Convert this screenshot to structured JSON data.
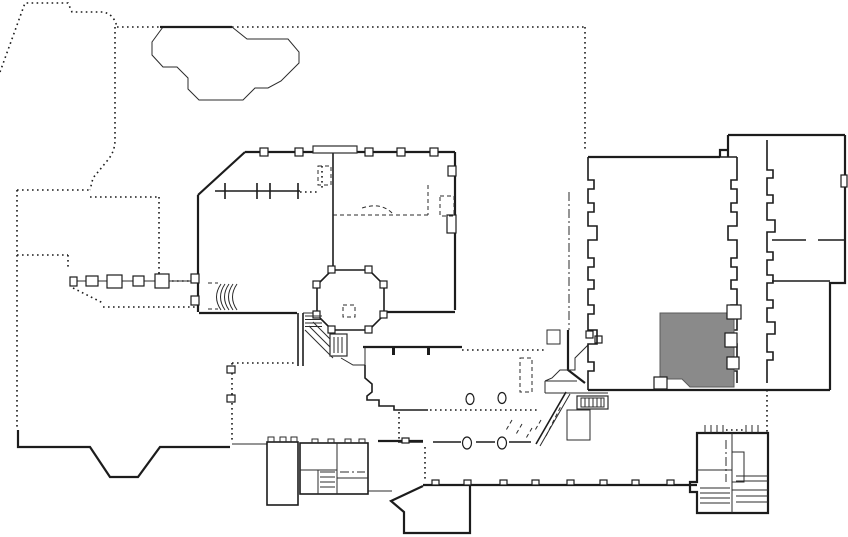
{
  "canvas": {
    "width": 848,
    "height": 537
  },
  "document": {
    "kind": "architectural-floor-plan",
    "visible_text": ""
  },
  "colors": {
    "background": "#ffffff",
    "wall": "#1c1c1c",
    "detail": "#2b2b2b",
    "highlight_fill": "#8a8a8a",
    "highlight_stroke": "#5a5a5a"
  },
  "highlighted_room": {
    "id": "highlighted-room",
    "state": "selected",
    "fill": "#8a8a8a"
  },
  "features": [
    "site-boundary-dotted-line",
    "pond-outline",
    "pergola-columns",
    "central-building",
    "octagonal-room",
    "curved-stair",
    "diagonal-stair",
    "south-terrace",
    "colonnade-with-oval-columns",
    "lower-room-block",
    "banquet-hall",
    "east-room-wing",
    "highlighted-room",
    "bottom-right-stair-block"
  ]
}
